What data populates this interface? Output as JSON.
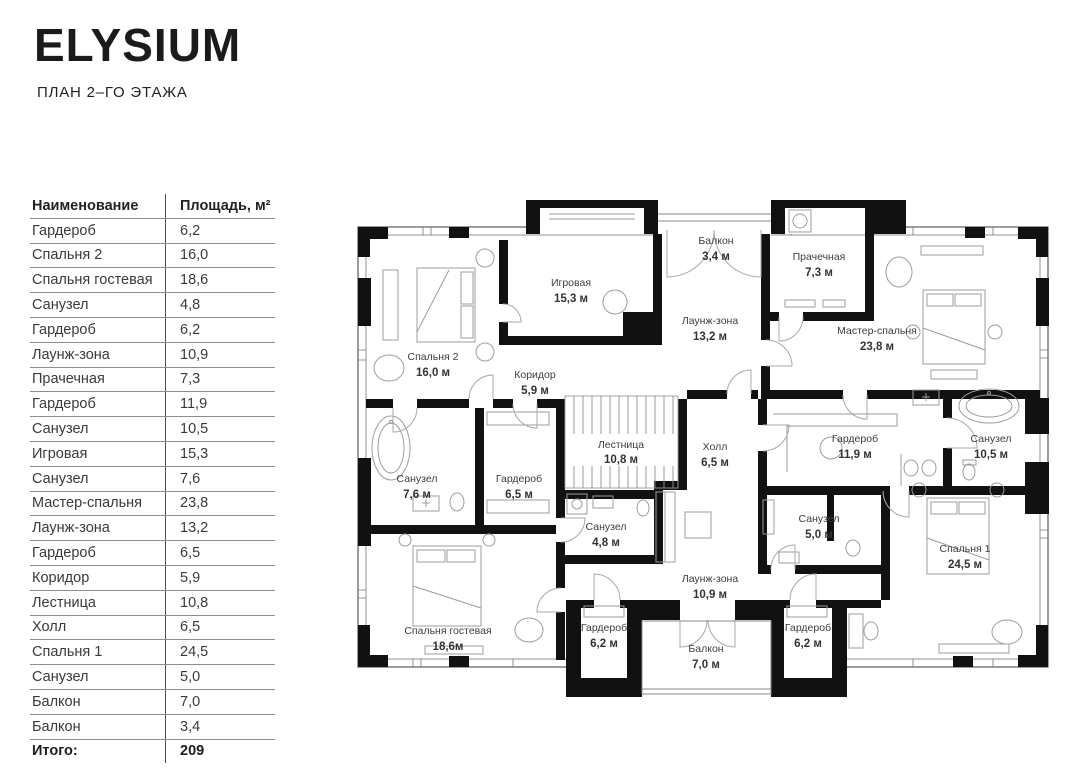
{
  "header": {
    "logo": "ELYSIUM",
    "subtitle": "ПЛАН 2–ГО ЭТАЖА"
  },
  "table": {
    "col_name": "Наименование",
    "col_area": "Площадь, м²",
    "rows": [
      {
        "name": "Гардероб",
        "area": "6,2"
      },
      {
        "name": "Спальня 2",
        "area": "16,0"
      },
      {
        "name": "Спальня гостевая",
        "area": "18,6"
      },
      {
        "name": "Санузел",
        "area": "4,8"
      },
      {
        "name": "Гардероб",
        "area": "6,2"
      },
      {
        "name": "Лаунж-зона",
        "area": "10,9"
      },
      {
        "name": "Прачечная",
        "area": "7,3"
      },
      {
        "name": "Гардероб",
        "area": "11,9"
      },
      {
        "name": "Санузел",
        "area": "10,5"
      },
      {
        "name": "Игровая",
        "area": "15,3"
      },
      {
        "name": "Санузел",
        "area": "7,6"
      },
      {
        "name": "Мастер-спальня",
        "area": "23,8"
      },
      {
        "name": "Лаунж-зона",
        "area": "13,2"
      },
      {
        "name": "Гардероб",
        "area": "6,5"
      },
      {
        "name": "Коридор",
        "area": "5,9"
      },
      {
        "name": "Лестница",
        "area": "10,8"
      },
      {
        "name": "Холл",
        "area": "6,5"
      },
      {
        "name": "Спальня 1",
        "area": "24,5"
      },
      {
        "name": "Санузел",
        "area": "5,0"
      },
      {
        "name": "Балкон",
        "area": "7,0"
      },
      {
        "name": "Балкон",
        "area": "3,4"
      }
    ],
    "total_label": "Итого:",
    "total_value": "209"
  },
  "plan": {
    "rooms": [
      {
        "name": "Балкон",
        "area": "3,4 м"
      },
      {
        "name": "Игровая",
        "area": "15,3 м"
      },
      {
        "name": "Прачечная",
        "area": "7,3 м"
      },
      {
        "name": "Лаунж-зона",
        "area": "13,2 м"
      },
      {
        "name": "Мастер-спальня",
        "area": "23,8 м"
      },
      {
        "name": "Спальня 2",
        "area": "16,0 м"
      },
      {
        "name": "Коридор",
        "area": "5,9 м"
      },
      {
        "name": "Лестница",
        "area": "10,8 м"
      },
      {
        "name": "Холл",
        "area": "6,5 м"
      },
      {
        "name": "Гардероб",
        "area": "11,9 м"
      },
      {
        "name": "Санузел",
        "area": "10,5 м"
      },
      {
        "name": "Санузел",
        "area": "7,6 м"
      },
      {
        "name": "Гардероб",
        "area": "6,5 м"
      },
      {
        "name": "Санузел",
        "area": "4,8 м"
      },
      {
        "name": "Санузел",
        "area": "5,0 м"
      },
      {
        "name": "Спальня 1",
        "area": "24,5 м"
      },
      {
        "name": "Спальня гостевая",
        "area": "18,6м"
      },
      {
        "name": "Гардероб",
        "area": "6,2 м"
      },
      {
        "name": "Лаунж-зона",
        "area": "10,9 м"
      },
      {
        "name": "Гардероб",
        "area": "6,2 м"
      },
      {
        "name": "Балкон",
        "area": "7,0 м"
      }
    ]
  }
}
